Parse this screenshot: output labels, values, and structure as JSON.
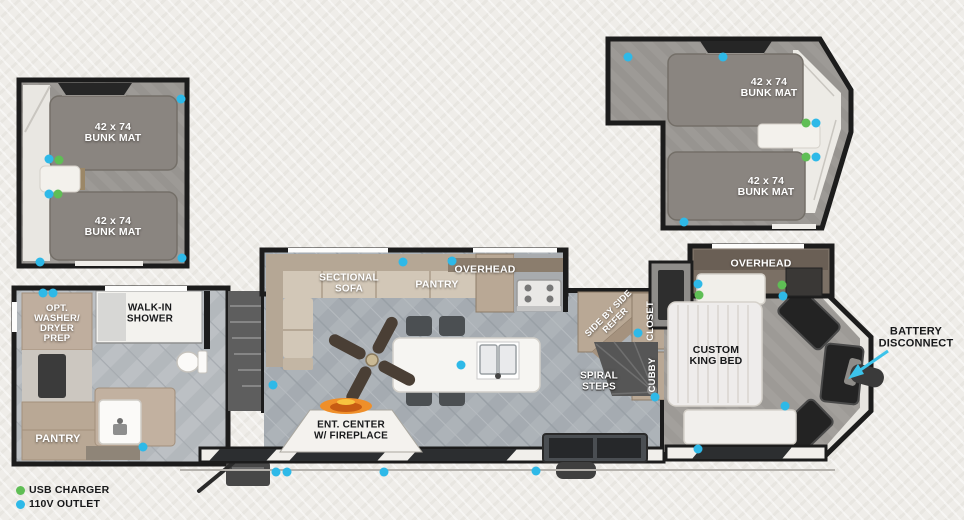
{
  "labels": {
    "bunk_mat": "42 x 74\nBUNK MAT",
    "opt_washer": "OPT.\nWASHER/\nDRYER\nPREP",
    "walk_in_shower": "WALK-IN\nSHOWER",
    "pantry_front": "PANTRY",
    "sectional_sofa": "SECTIONAL\nSOFA",
    "pantry_kitchen": "PANTRY",
    "overhead_kitchen": "OVERHEAD",
    "side_by_side_refer": "SIDE BY SIDE\nREFER",
    "spiral_steps": "SPIRAL\nSTEPS",
    "closet": "CLOSET",
    "cubby": "CUBBY",
    "custom_king_bed": "CUSTOM\nKING BED",
    "overhead_bedroom": "OVERHEAD",
    "ent_center": "ENT. CENTER\nW/ FIREPLACE",
    "battery_disconnect": "BATTERY\nDISCONNECT"
  },
  "legend": {
    "usb": {
      "label": "USB CHARGER",
      "color": "#5fbe55"
    },
    "outlet": {
      "label": "110V OUTLET",
      "color": "#2eb9e8"
    }
  },
  "colors": {
    "arrow_accent": "#3cc3ea",
    "wall": "#1c1c1c"
  }
}
